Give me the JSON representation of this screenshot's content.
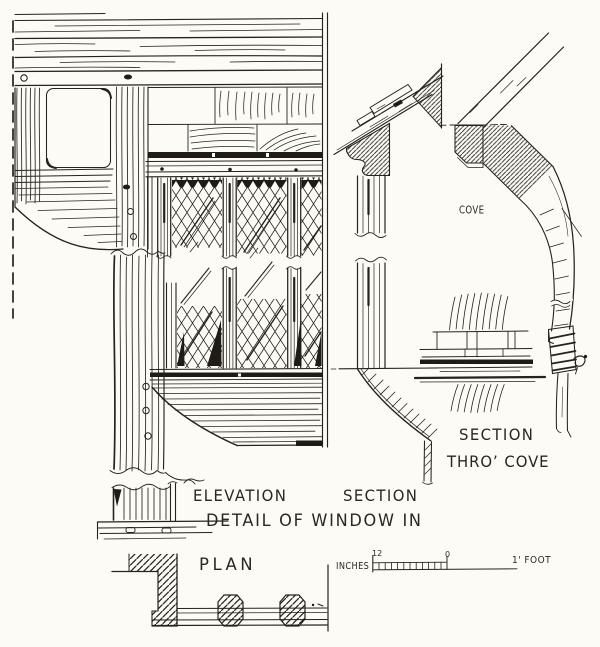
{
  "colors": {
    "ink": "#26231d",
    "paper": "#fcfbf6"
  },
  "drawing": {
    "labels": {
      "cove": "COVE",
      "section_right_line1": "SECTION",
      "section_right_line2": "THRO’ COVE",
      "elevation": "ELEVATION",
      "section_center": "SECTION",
      "title": "DETAIL OF WINDOW IN",
      "plan": "PLAN"
    },
    "scale_bar": {
      "left_label": "INCHES",
      "start_value": "12",
      "zero_value": "0",
      "right_label": "1' FOOT"
    }
  }
}
